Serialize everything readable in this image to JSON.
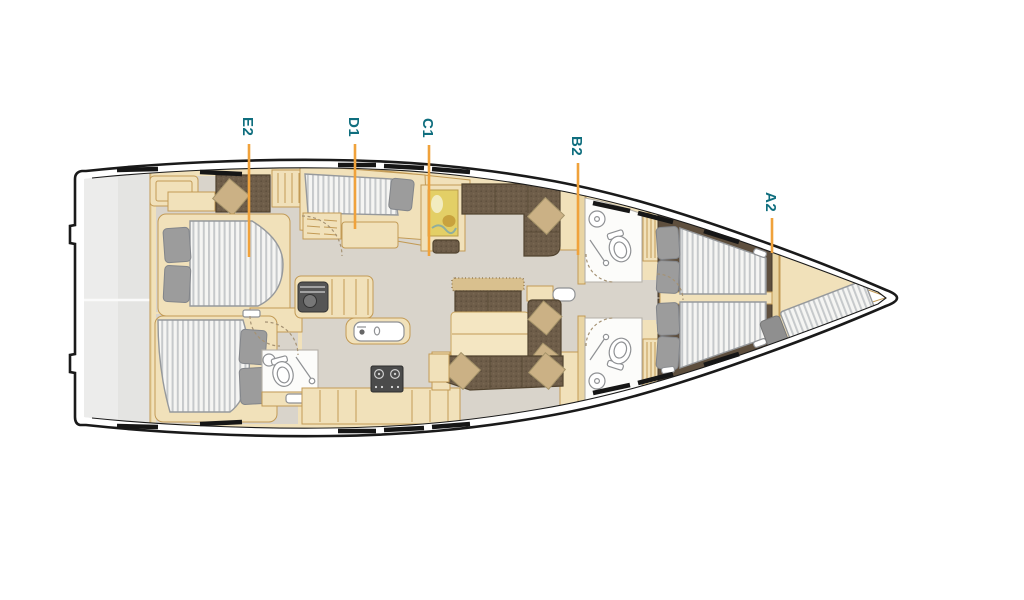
{
  "diagram": {
    "type": "yacht-interior-deck-plan",
    "orientation": "bow-right",
    "labels": [
      {
        "text": "E2",
        "x": 249,
        "text_y": 117,
        "line_y1": 144,
        "line_y2": 257
      },
      {
        "text": "D1",
        "x": 355,
        "text_y": 117,
        "line_y1": 144,
        "line_y2": 229
      },
      {
        "text": "C1",
        "x": 429,
        "text_y": 118,
        "line_y1": 145,
        "line_y2": 256
      },
      {
        "text": "B2",
        "x": 578,
        "text_y": 136,
        "line_y1": 163,
        "line_y2": 255
      },
      {
        "text": "A2",
        "x": 772,
        "text_y": 192,
        "line_y1": 218,
        "line_y2": 253
      }
    ],
    "colors": {
      "label_text": "#0f6e7e",
      "leader_line": "#f0a23b",
      "hull_outline": "#1a1a1a",
      "wood": "#f1e1ba",
      "wood_line": "#c29a55",
      "wood_mid": "#e9d5a4",
      "floor": "#d9d4cb",
      "platform": "#e4e4e2",
      "mattress": "#f5f5f3",
      "mattress_stripe": "#c6c9cb",
      "mattress_edge": "#96999c",
      "pillow": "#9c9c9c",
      "pillow_line": "#82858a",
      "sofa": "#6e5d49",
      "sofa_line": "#51432f",
      "cushion": "#cbb185",
      "cushion_line": "#a6946a",
      "fixture_line": "#8f9194",
      "room": "#fcfcfa",
      "room_line": "#b5b1a8",
      "door_arc": "#a59274",
      "window_dash": "#161616"
    }
  }
}
